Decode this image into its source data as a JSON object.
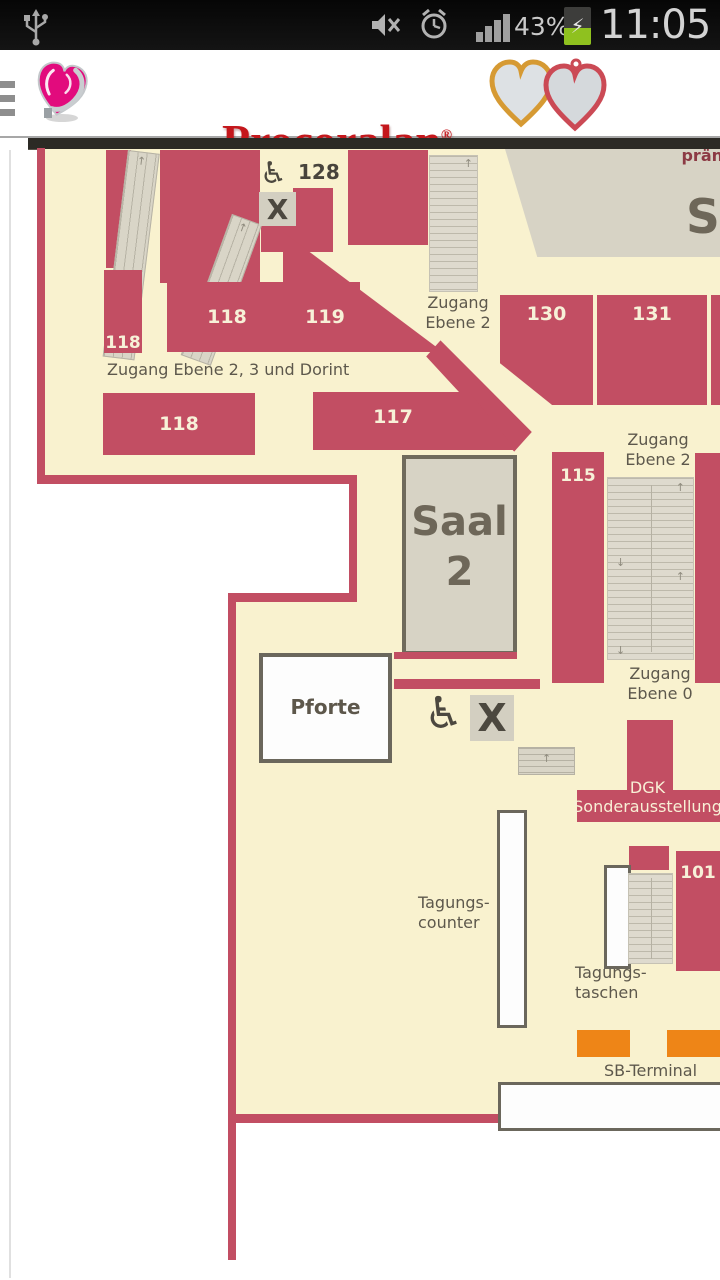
{
  "status_bar": {
    "time": "11:05",
    "battery_percent": "43%",
    "charging_bolt": "⚡"
  },
  "header": {
    "brand": "Procoralan",
    "registered_mark": "®",
    "subtitle": "Ivabradin"
  },
  "map": {
    "colors": {
      "room_red": "#c24e63",
      "floor_cream": "#f9f2cf",
      "hall_gray": "#d7d3c5",
      "terminal_orange": "#ee8517"
    },
    "rooms": {
      "r128": "128",
      "r118_top": "118",
      "r119": "119",
      "r118_left": "118",
      "r118_mid": "118",
      "r117": "117",
      "r130": "130",
      "r131": "131",
      "r115": "115",
      "r101": "101"
    },
    "labels": {
      "zugang_ebene2_top": "Zugang\nEbene 2",
      "zugang_dorint": "Zugang Ebene 2, 3 und Dorint",
      "zugang_ebene2_mid": "Zugang\nEbene 2",
      "zugang_ebene0": "Zugang\nEbene 0",
      "saal2": "Saal\n2",
      "saal1_initial": "S",
      "praemiert_partial": "prän",
      "pforte": "Pforte",
      "dgk_sonderausstellung": "DGK\nSonderausstellung",
      "tagungscounter": "Tagungs-\ncounter",
      "tagungstaschen": "Tagungs-\ntaschen",
      "sb_terminal": "SB-Terminal"
    },
    "icons": {
      "wheelchair": "♿",
      "x_marker": "X",
      "up_arrow": "↑",
      "down_arrow": "↓"
    }
  }
}
